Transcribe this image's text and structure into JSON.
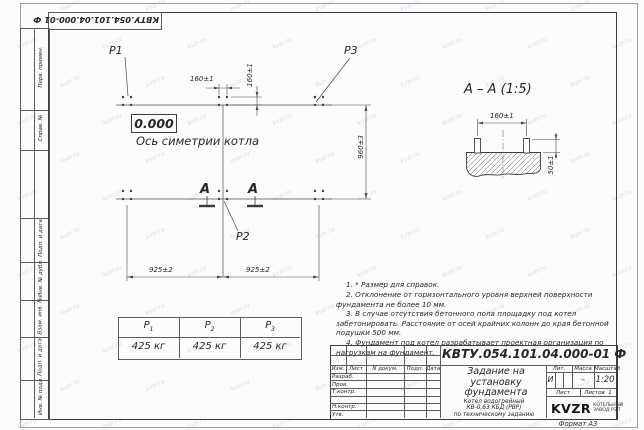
{
  "sheet": {
    "designation": "КВТУ.054.101.04.000-01 Ф",
    "format_label": "Формат А3",
    "watermark": "kvzr.ru"
  },
  "margin_labels": {
    "perv_primen": "Перв. примен.",
    "sprav_n": "Справ. №",
    "podp_data_1": "Подп. и дата",
    "inv_dubl": "Инв. № дубл.",
    "vzam_inv": "Взам. инв. №",
    "podp_data_2": "Подп. и дата",
    "inv_podl": "Инв. № подл."
  },
  "plan": {
    "elevation": "0.000",
    "axis_label": "Ось симетрии котла",
    "p1": "P1",
    "p2": "P2",
    "p3": "P3",
    "dim_160_top": "160±1",
    "dim_160_side": "160±1",
    "dim_960": "960±3",
    "dim_925_left": "925±2",
    "dim_925_right": "925±2",
    "section_letter_left": "А",
    "section_letter_right": "А"
  },
  "section_view": {
    "title": "А – А (1:5)",
    "dim_width": "160±1",
    "dim_height": "50±1"
  },
  "notes": [
    "1. * Размер для справок.",
    "2. Отклонение от горизонтального уровня верхней поверхности фундамента не более 10 мм.",
    "3. В случае отсутствия бетонного пола площадку под котел забетонировать. Расстояние от осей крайних колонн до края бетонной подушки 500 мм.",
    "4. Фундамент под котел разрабатывает проектная организация по нагрузкам на фундамент."
  ],
  "loads": {
    "items": [
      {
        "name": "Р",
        "sub": "1",
        "value": "425 кг"
      },
      {
        "name": "Р",
        "sub": "2",
        "value": "425 кг"
      },
      {
        "name": "Р",
        "sub": "3",
        "value": "425 кг"
      }
    ]
  },
  "titleblock": {
    "designation_full": "КВТУ.054.101.04.000-01  Ф",
    "title_lines": [
      "Задание на",
      "установку",
      "фундамента"
    ],
    "object_lines": [
      "Котел водогрейный",
      "КВ-0,63 КБД (РВР)",
      "по техническому заданию"
    ],
    "col_headers": [
      "Изм.",
      "Лист",
      "N докум.",
      "Подп.",
      "Дата"
    ],
    "sig_rows": [
      "Разраб.",
      "Пров.",
      "Т.контр.",
      "Н.контр.",
      "Утв."
    ],
    "lit_label": "Лит.",
    "mass_label": "Масса",
    "scale_label": "Масштаб",
    "lit_value": "И",
    "mass_value": "–",
    "scale_value": "1:20",
    "sheet_label": "Лист",
    "sheets_label": "Листов",
    "sheets_value": "1",
    "brand": "KVZR",
    "org_line1": "КОТЕЛЬНЫЙ",
    "org_line2": "ЗАВОД РЭП"
  },
  "colors": {
    "ink": "#24262a",
    "line": "#585c63",
    "watermark": "#96a2bc"
  }
}
